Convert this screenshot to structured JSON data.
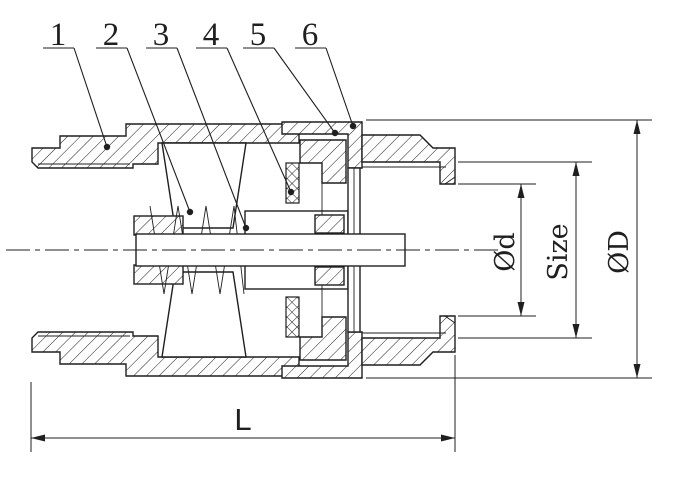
{
  "drawing": {
    "title": "spring-check-valve-cross-section",
    "background_color": "#ffffff",
    "line_color": "#1f1f1f",
    "callouts": [
      {
        "label": "1"
      },
      {
        "label": "2"
      },
      {
        "label": "3"
      },
      {
        "label": "4"
      },
      {
        "label": "5"
      },
      {
        "label": "6"
      }
    ],
    "dimensions": {
      "bore_diameter_label": "Ød",
      "port_size_label": "Size",
      "outer_diameter_label": "ØD",
      "length_label": "L"
    }
  }
}
